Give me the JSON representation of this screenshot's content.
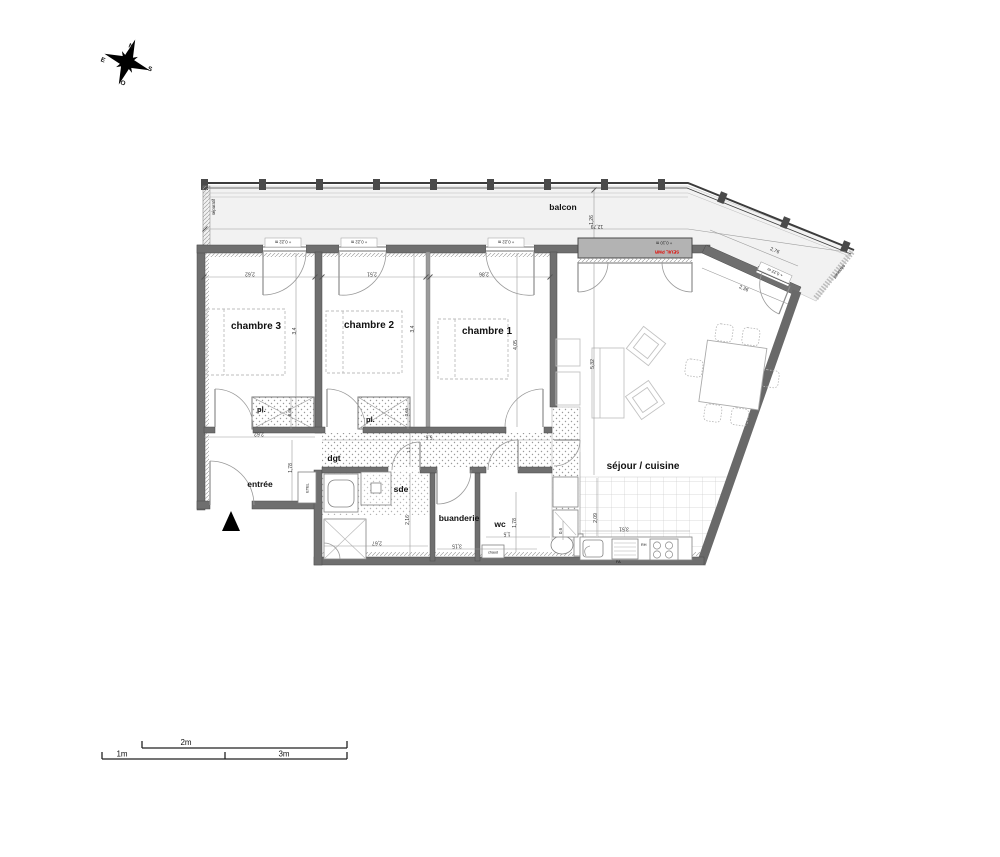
{
  "compass": {
    "n": "N",
    "e": "E",
    "s": "S",
    "o": "O"
  },
  "rooms": {
    "balcony": "balcon",
    "bedroom1": "chambre 1",
    "bedroom2": "chambre 2",
    "bedroom3": "chambre 3",
    "living_kitchen": "séjour / cuisine",
    "entry": "entrée",
    "hallway": "dgt",
    "bathroom": "sde",
    "laundry": "buanderie",
    "toilet": "wc",
    "closet3": "pl.",
    "closet2": "pl.",
    "utility": "ETEL",
    "water_heater": "chaud"
  },
  "annotations": {
    "separator_left": "séparatif",
    "separator_right": "séparatif",
    "threshold": "SEUIL PMR",
    "level_bay": "+ 0,10 m",
    "sill_height": "+ 0,22 m",
    "fridge": "RH",
    "dishwasher": "FA"
  },
  "dimensions": {
    "balcony_length": "12,79",
    "balcony_depth": "1,26",
    "balcony_diagonal": "2,76",
    "living_diagonal": "2,36",
    "bedroom3_width": "2,62",
    "bedroom3_depth": "3,4",
    "bedroom2_width": "2,51",
    "bedroom2_depth": "3,4",
    "bedroom1_width": "2,86",
    "bedroom1_depth": "4,05",
    "closet3_depth": "0,66",
    "closet2_depth": "0,65",
    "entry_width": "2,62",
    "entry_depth": "1,78",
    "hallway_length": "5,6",
    "hallway_width": "1,1",
    "bathroom_depth": "2,16",
    "bathroom_width": "2,67",
    "laundry_width": "3,15",
    "toilet_width": "1,5",
    "toilet_depth": "1,78",
    "living_depth": "5,32",
    "kitchen_depth": "2,09",
    "kitchen_width": "3,51",
    "kitchen_offset": "0,6"
  },
  "scale_bar": {
    "one": "1m",
    "two": "2m",
    "three": "3m"
  },
  "colors": {
    "wall": "#6f6f6f",
    "bay": "#b3b3b3",
    "alert_red": "#e10600",
    "balcony_floor": "#f2f2f2"
  }
}
